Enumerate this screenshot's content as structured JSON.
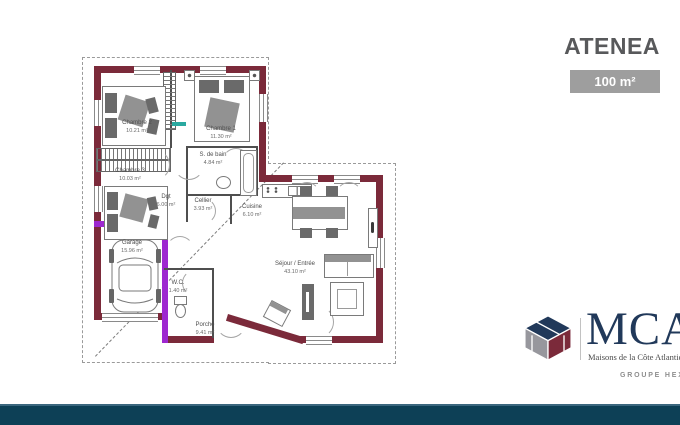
{
  "header": {
    "title": "ATENEA",
    "area_badge": "100 m²"
  },
  "plan": {
    "rooms": [
      {
        "name": "Chambre 2",
        "area": "10.21 m²"
      },
      {
        "name": "Chambre 1",
        "area": "11.30 m²"
      },
      {
        "name": "Chambre 3",
        "area": "10.03 m²"
      },
      {
        "name": "S. de bain",
        "area": "4.84 m²"
      },
      {
        "name": "Dgt",
        "area": "6.00 m²"
      },
      {
        "name": "Cellier",
        "area": "3.93 m²"
      },
      {
        "name": "Cuisine",
        "area": "6.10 m²"
      },
      {
        "name": "Garage",
        "area": "15.96 m²"
      },
      {
        "name": "W.C.",
        "area": "1.40 m²"
      },
      {
        "name": "Séjour / Entrée",
        "area": "43.10 m²"
      },
      {
        "name": "Porche",
        "area": "9.41 m²"
      }
    ],
    "colors": {
      "exterior_wall": "#7b2a3a",
      "highlight_wall": "#9e28d0",
      "teal_marker": "#2aa9a0",
      "overhang_dash": "#9a9a9a"
    }
  },
  "logo": {
    "brand": "MCA",
    "tagline": "Maisons de la Côte Atlantique",
    "group": "GROUPE HEXA",
    "colors": {
      "navy": "#21395a",
      "gray": "#97979d",
      "maroon": "#7b2a3a"
    }
  },
  "footer": {
    "bar_color": "#0d4056"
  },
  "badge_color": "#9e9e9e"
}
